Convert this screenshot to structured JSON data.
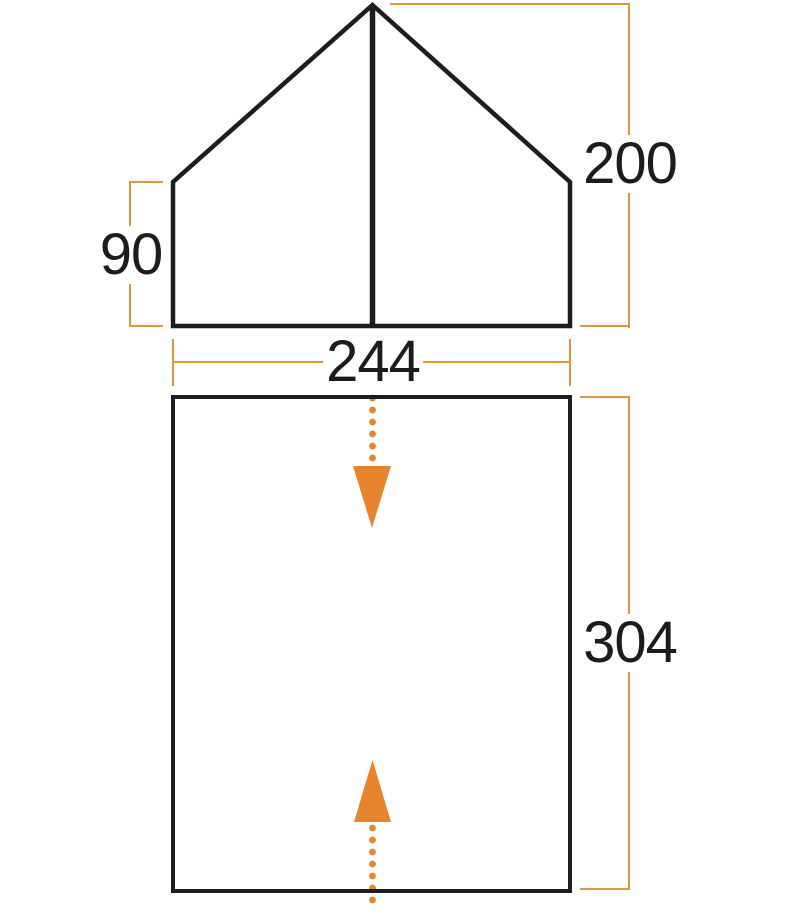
{
  "diagram": {
    "name": "tent-dimensions-diagram",
    "views": [
      {
        "name": "front-elevation",
        "shape": "pentagon-with-center-pole"
      },
      {
        "name": "floor-plan",
        "shape": "rectangle"
      }
    ],
    "arrows": [
      {
        "name": "front-door-arrow",
        "direction": "down",
        "style": "orange-dotted"
      },
      {
        "name": "rear-door-arrow",
        "direction": "up",
        "style": "orange-dotted"
      }
    ]
  },
  "labels": {
    "side_wall_height": "90",
    "peak_height": "200",
    "width": "244",
    "depth": "304"
  },
  "colors": {
    "dimension_line_orange": "#e2953f",
    "arrow_orange": "#e8832d",
    "outline_black": "#1d1d1d",
    "text_black": "#1c1c1c",
    "background": "#ffffff"
  }
}
